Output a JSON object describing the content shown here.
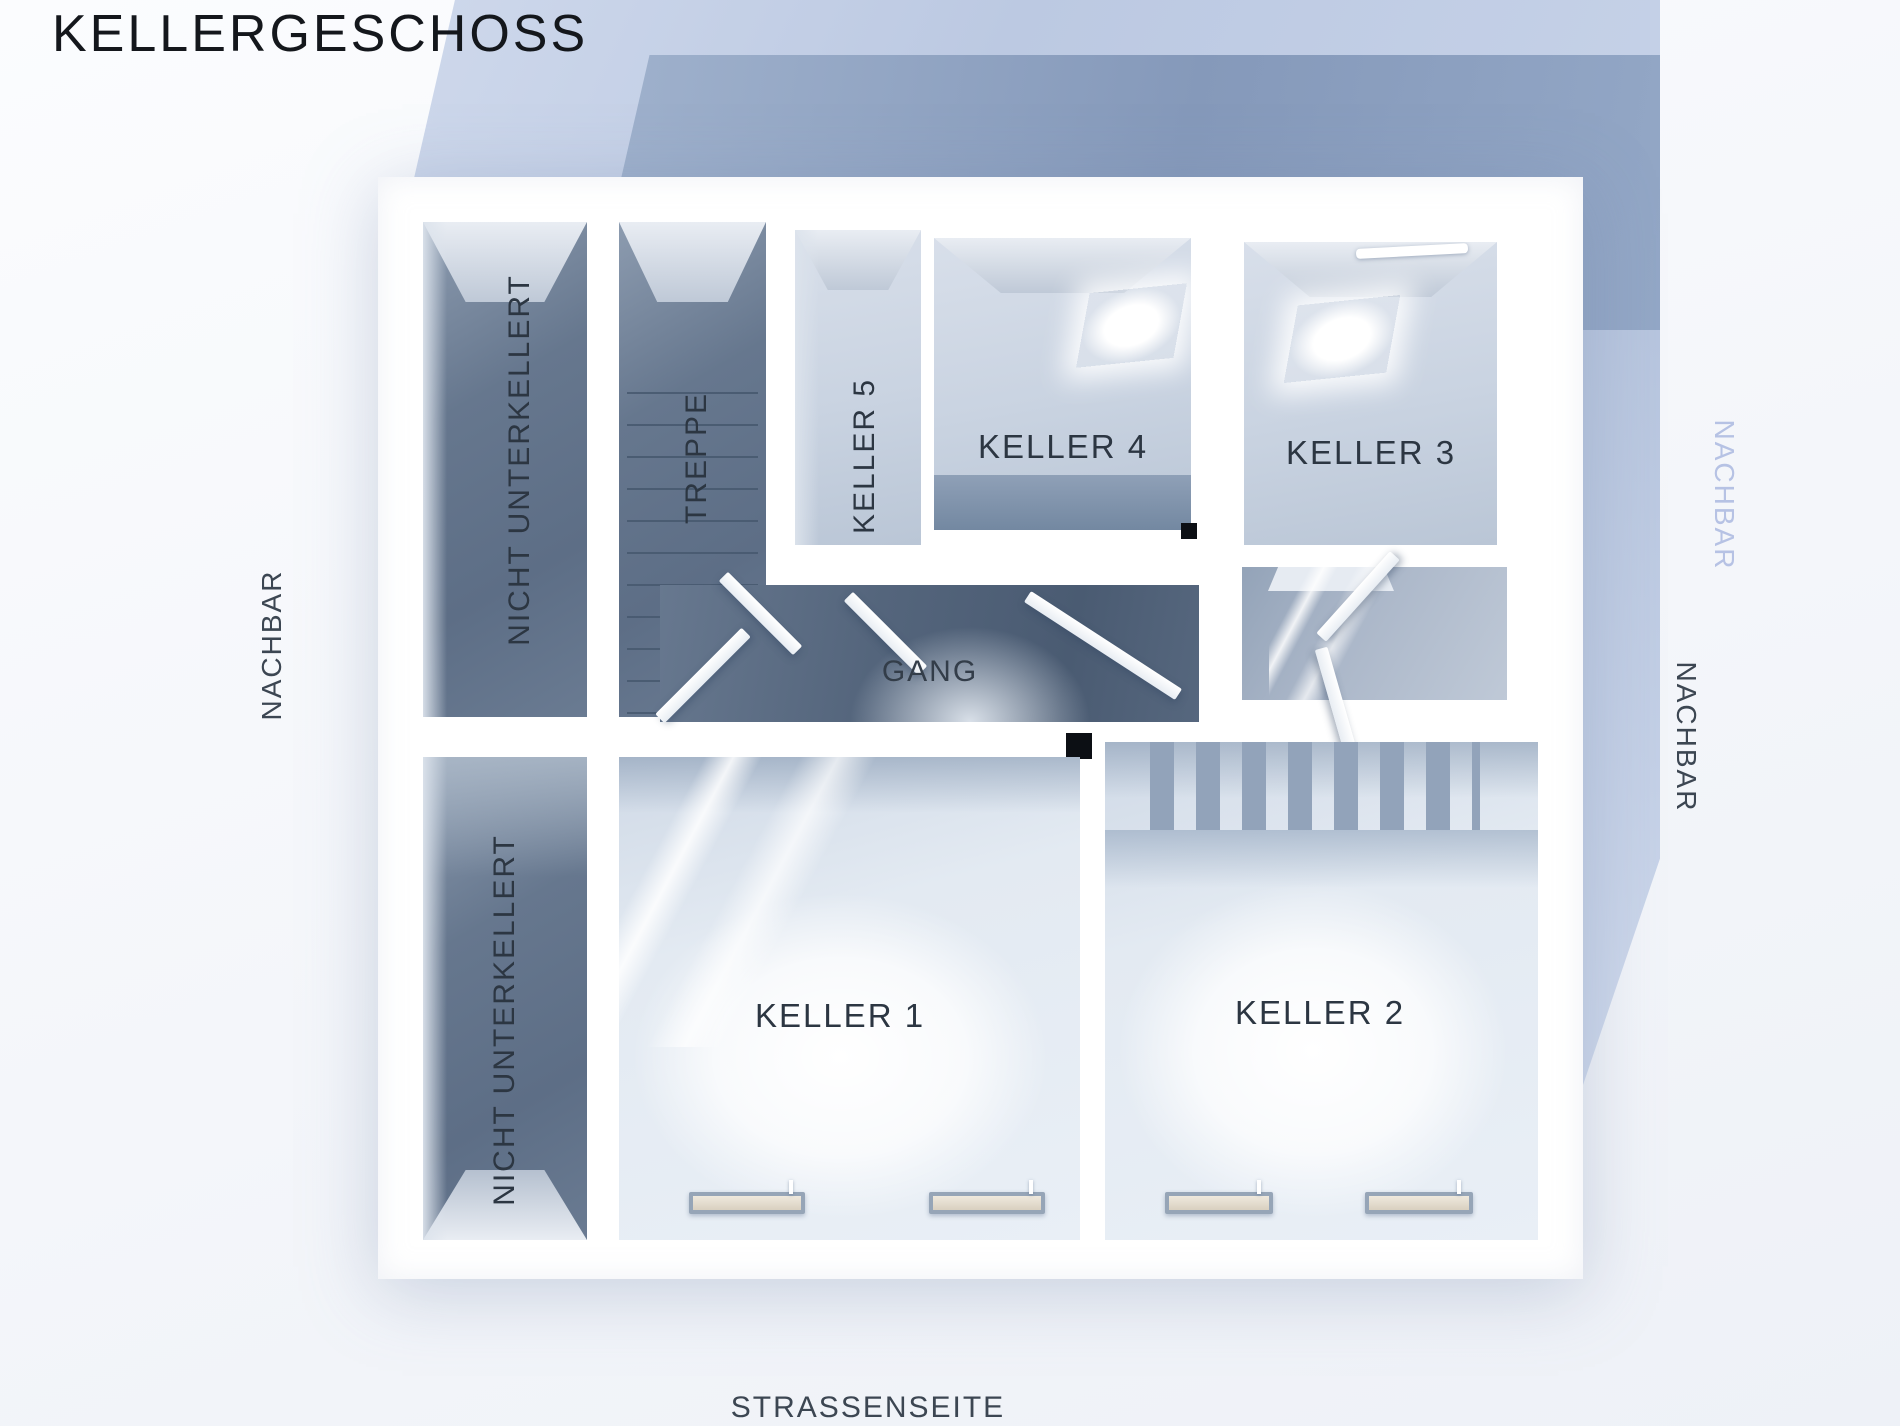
{
  "title": "KELLERGESCHOSS",
  "rooms": {
    "nu_top": {
      "label": "NICHT UNTERKELLERT",
      "orientation": "vertical"
    },
    "treppe": {
      "label": "TREPPE",
      "orientation": "vertical"
    },
    "keller5": {
      "label": "KELLER 5",
      "orientation": "vertical"
    },
    "keller4": {
      "label": "KELLER 4",
      "orientation": "horizontal"
    },
    "keller3": {
      "label": "KELLER 3",
      "orientation": "horizontal"
    },
    "gang": {
      "label": "GANG",
      "orientation": "horizontal"
    },
    "nu_bottom": {
      "label": "NICHT UNTERKELLERT",
      "orientation": "vertical"
    },
    "keller1": {
      "label": "KELLER 1",
      "orientation": "horizontal"
    },
    "keller2": {
      "label": "KELLER 2",
      "orientation": "horizontal"
    }
  },
  "surroundings": {
    "left": {
      "label": "NACHBAR",
      "side": "left"
    },
    "right_upper": {
      "label": "NACHBAR",
      "side": "right",
      "tone": "light-blue"
    },
    "right_lower": {
      "label": "NACHBAR",
      "side": "right",
      "tone": "dark"
    },
    "street": {
      "label": "STRASSENSEITE",
      "side": "bottom"
    }
  },
  "colors": {
    "background_pale_blue": "#c6d2e8",
    "background_slate_band": "#8599ba",
    "wall_white": "#ffffff",
    "room_dark_floor": "#5d6e86",
    "corridor_floor": "#54657c",
    "room_light_floor": "#c9d3e1",
    "bright_room_glow": "#ffffff",
    "label_text": "#2c3642",
    "nachbar_light_text": "#b6c2e4",
    "column_marker": "#0c0f14"
  }
}
